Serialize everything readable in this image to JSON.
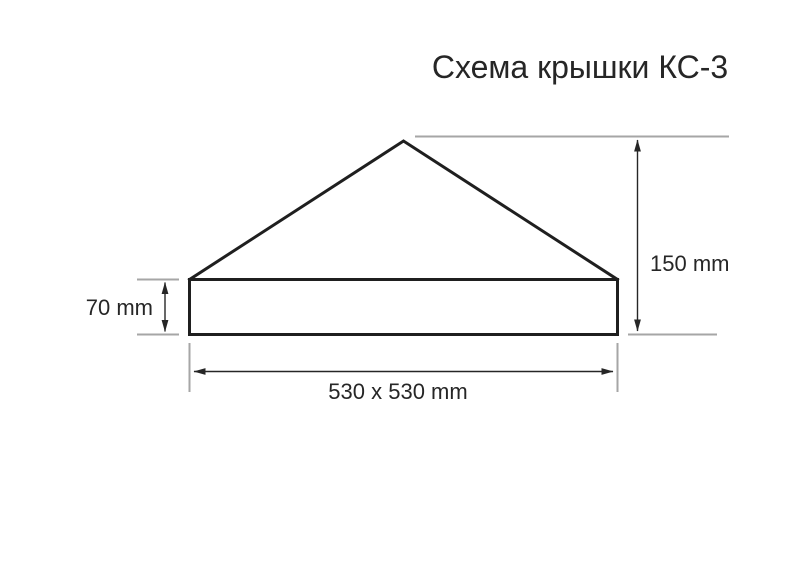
{
  "title": "Схема крышки КС-3",
  "diagram": {
    "type": "technical-drawing",
    "subject": "pyramid-cap-cross-section",
    "labels": {
      "total_height": "150 mm",
      "base_height": "70 mm",
      "footprint": "530 x 530 mm"
    },
    "values": {
      "total_height_mm": 150,
      "base_height_mm": 70,
      "footprint": "530 x 530",
      "unit": "mm"
    },
    "colors": {
      "outline": "#1f1f1f",
      "dimension": "#262626",
      "extension": "#a6a6a6",
      "text": "#262626",
      "background": "#ffffff"
    }
  }
}
